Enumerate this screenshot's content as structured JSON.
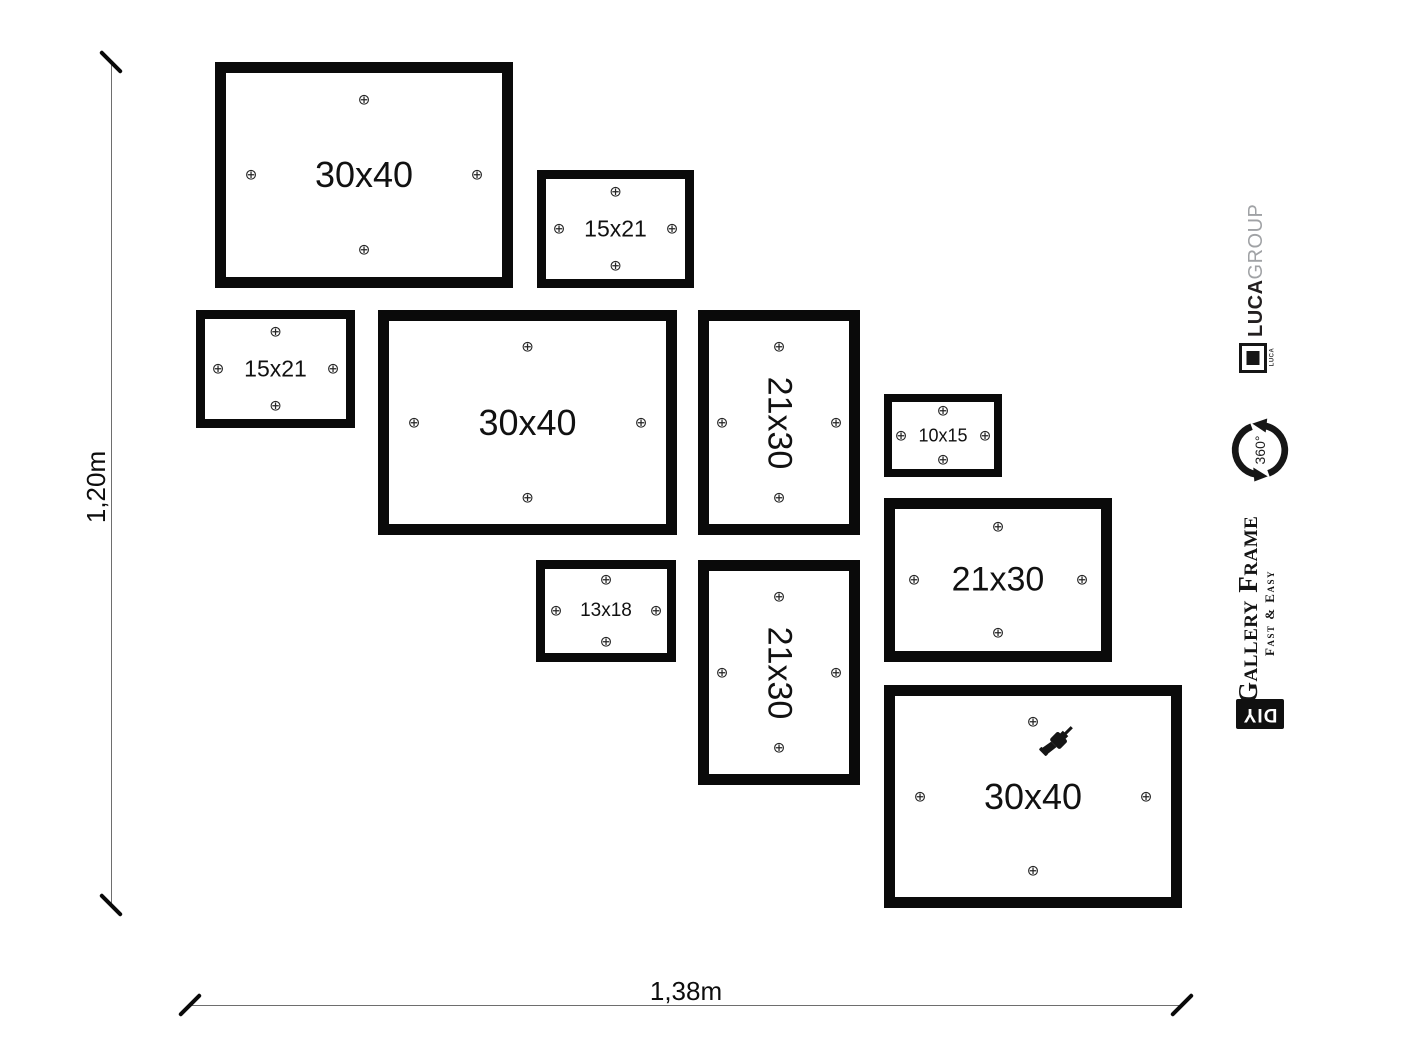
{
  "colors": {
    "ink": "#111111",
    "frame_border": "#0a0a0a",
    "brand_gray": "#a0a2a5",
    "dim_line": "#6e6e6e"
  },
  "dimension_labels": {
    "height": "1,20m",
    "width": "1,38m"
  },
  "icons": {
    "screw": "⊕"
  },
  "frames": [
    {
      "label": "30x40",
      "x": 215,
      "y": 62,
      "w": 298,
      "h": 226,
      "border": 11,
      "font_size": 36,
      "orientation": "landscape",
      "drill": false
    },
    {
      "label": "15x21",
      "x": 537,
      "y": 170,
      "w": 157,
      "h": 118,
      "border": 9,
      "font_size": 23,
      "orientation": "landscape",
      "drill": false
    },
    {
      "label": "15x21",
      "x": 196,
      "y": 310,
      "w": 159,
      "h": 118,
      "border": 9,
      "font_size": 23,
      "orientation": "landscape",
      "drill": false
    },
    {
      "label": "30x40",
      "x": 378,
      "y": 310,
      "w": 299,
      "h": 225,
      "border": 11,
      "font_size": 36,
      "orientation": "landscape",
      "drill": false
    },
    {
      "label": "21x30",
      "x": 698,
      "y": 310,
      "w": 162,
      "h": 225,
      "border": 11,
      "font_size": 34,
      "orientation": "portrait",
      "drill": false
    },
    {
      "label": "10x15",
      "x": 884,
      "y": 394,
      "w": 118,
      "h": 83,
      "border": 8,
      "font_size": 18,
      "orientation": "landscape",
      "drill": false
    },
    {
      "label": "21x30",
      "x": 884,
      "y": 498,
      "w": 228,
      "h": 164,
      "border": 11,
      "font_size": 34,
      "orientation": "landscape",
      "drill": false
    },
    {
      "label": "13x18",
      "x": 536,
      "y": 560,
      "w": 140,
      "h": 102,
      "border": 9,
      "font_size": 19,
      "orientation": "landscape",
      "drill": false
    },
    {
      "label": "21x30",
      "x": 698,
      "y": 560,
      "w": 162,
      "h": 225,
      "border": 11,
      "font_size": 34,
      "orientation": "portrait",
      "drill": false
    },
    {
      "label": "30x40",
      "x": 884,
      "y": 685,
      "w": 298,
      "h": 223,
      "border": 11,
      "font_size": 36,
      "orientation": "landscape",
      "drill": true
    }
  ],
  "branding": {
    "brand_bold": "LUCA",
    "brand_light": "GROUP",
    "logo_text": "LUCA",
    "rotation_label": "360°",
    "product_title": "Gallery Frame",
    "product_subtitle": "Fast & Easy",
    "diy": "DIY"
  }
}
